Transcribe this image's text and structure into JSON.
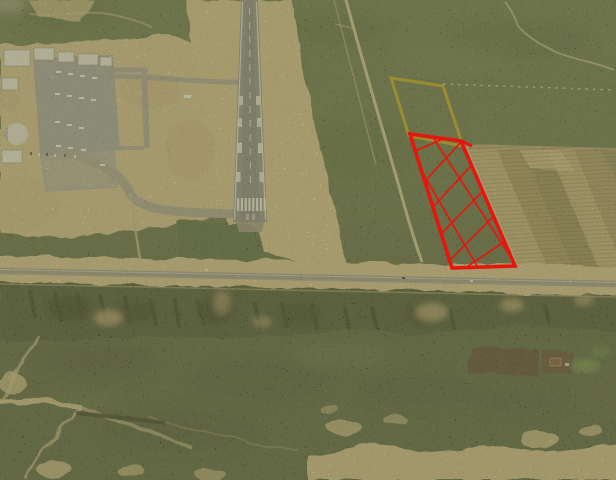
{
  "scene": {
    "kind": "aerial-photograph",
    "palette": {
      "scrub_green": "#5a6a43",
      "scrub_dark": "#3f4c2e",
      "sand": "#d7c190",
      "sand_light": "#e3d2a4",
      "runway_gray": "#8c8d8e",
      "apron_gray": "#a2a2a2",
      "road_gray": "#98948a",
      "cliff_dark": "#1f2815",
      "plowed_field_brown": "#4a3829",
      "building_white": "#f0efe9"
    }
  },
  "annotations": {
    "yellow_parcel": {
      "color": "#9c8e30",
      "stroke_width": 3,
      "vertices": [
        [
          391,
          78
        ],
        [
          443,
          86
        ],
        [
          463,
          146
        ],
        [
          409,
          136
        ]
      ]
    },
    "red_parcel": {
      "color": "#e8150d",
      "stroke_width": 3.6,
      "hatch_stroke_width": 1.8,
      "vertices": [
        [
          410,
          134
        ],
        [
          461,
          141
        ],
        [
          515,
          266
        ],
        [
          452,
          268
        ]
      ],
      "spur": [
        461,
        141,
        472,
        146
      ],
      "hatch_lines": [
        [
          415,
          151,
          443,
          139
        ],
        [
          425,
          181,
          461,
          142
        ],
        [
          433,
          207,
          471,
          166
        ],
        [
          441,
          234,
          483,
          191
        ],
        [
          450,
          260,
          493,
          217
        ],
        [
          468,
          266,
          504,
          242
        ],
        [
          434,
          139,
          510,
          256
        ],
        [
          421,
          170,
          477,
          266
        ]
      ]
    }
  }
}
